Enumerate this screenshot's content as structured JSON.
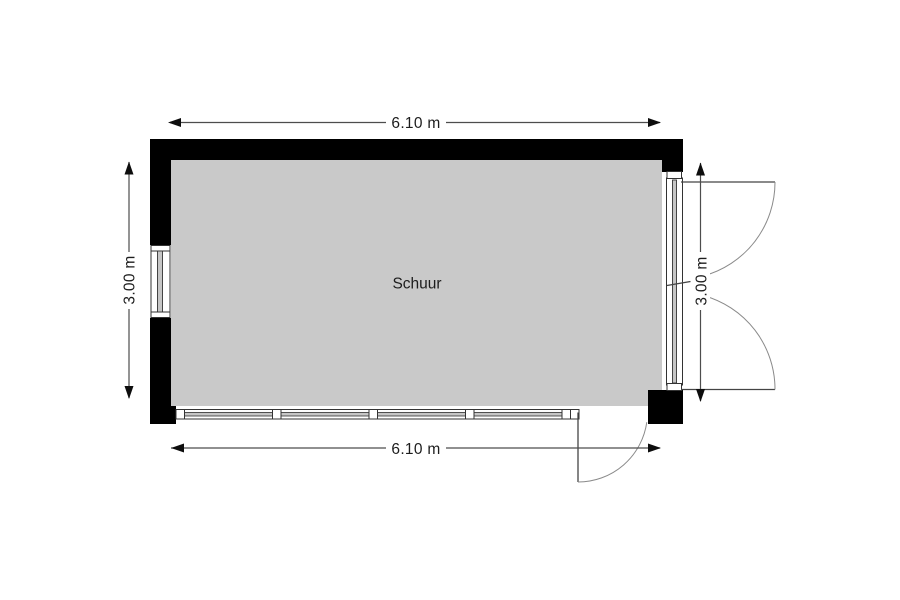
{
  "plan": {
    "room": {
      "label": "Schuur"
    },
    "dimensions": {
      "top": "6.10 m",
      "bottom": "6.10 m",
      "left": "3.00 m",
      "right": "3.00 m"
    },
    "colors": {
      "background": "#ffffff",
      "wall": "#000000",
      "floor": "#c9c9c9",
      "opening": "#ffffff",
      "frame_stroke": "#333333",
      "glazing_fill": "#c6c6c6",
      "door_leaf": "#444444",
      "door_arc": "#8a8a8a",
      "dimension_line": "#4d4d4d",
      "arrow": "#0d0d0d",
      "text": "#1d1d1d"
    }
  }
}
